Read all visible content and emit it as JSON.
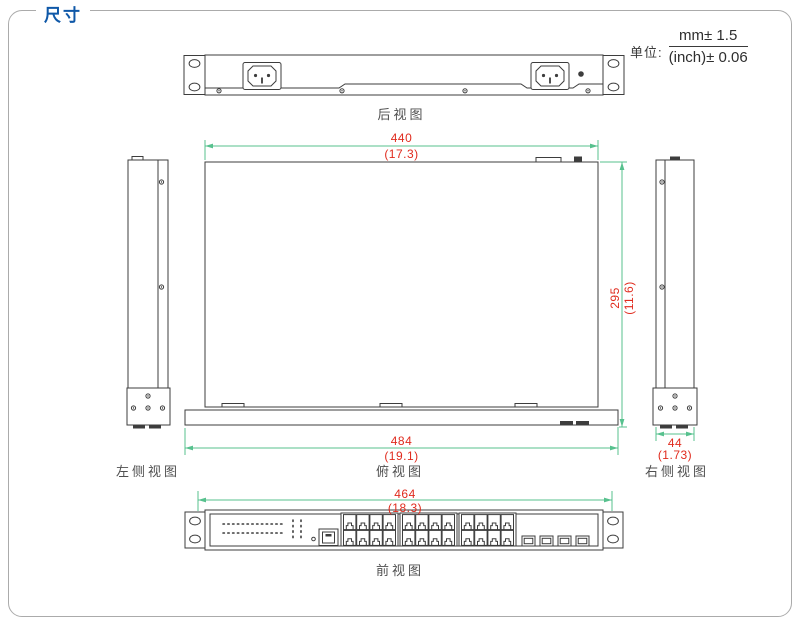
{
  "title": "尺寸",
  "unit": {
    "label": "单位:",
    "mm": "mm±  1.5",
    "inch": "(inch)±  0.06"
  },
  "views": {
    "rear": "后视图",
    "top": "俯视图",
    "left": "左侧视图",
    "right": "右侧视图",
    "front": "前视图"
  },
  "dims": {
    "width": {
      "mm": "440",
      "inch": "(17.3)"
    },
    "depth": {
      "mm": "295",
      "inch": "(11.6)"
    },
    "overall_width": {
      "mm": "484",
      "inch": "(19.1)"
    },
    "side_width": {
      "mm": "44",
      "inch": "(1.73)"
    },
    "mount_width": {
      "mm": "464",
      "inch": "(18.3)"
    }
  },
  "colors": {
    "title_blue": "#0f58a8",
    "dimension_line_green": "#57c18e",
    "dimension_text_red": "#e02b1e",
    "drawing_line": "#3d3d3d",
    "border_gray": "#ababab"
  },
  "device": {
    "rj45_port_count": 24,
    "sfp_slot_count": 4,
    "power_inlet_count": 2
  }
}
